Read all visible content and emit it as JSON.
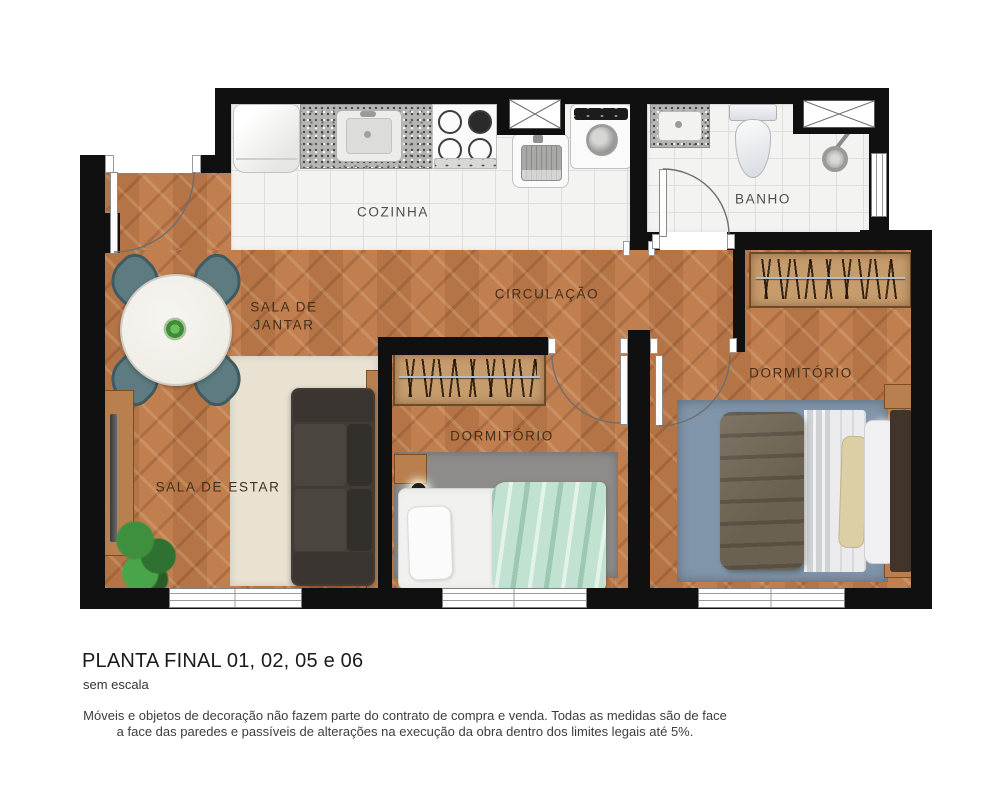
{
  "rooms": {
    "kitchen": "COZINHA",
    "bathroom": "BANHO",
    "dining": "SALA DE JANTAR",
    "living": "SALA DE ESTAR",
    "hallway": "CIRCULAÇÃO",
    "bedroom1": "DORMITÓRIO",
    "bedroom2": "DORMITÓRIO"
  },
  "title_block": {
    "title": "PLANTA FINAL 01, 02, 05 e 06",
    "scale_note": "sem escala",
    "disclaimer_line1": "Móveis e objetos de decoração não fazem parte do contrato de compra e venda. Todas as medidas são de face",
    "disclaimer_line2": "a face das paredes e passíveis de alterações na execução da obra dentro dos limites legais até 5%."
  },
  "colors": {
    "wall": "#101010",
    "wood": "#bb7a4c",
    "tile": "#f3f3f1",
    "grout": "#e0dfdd",
    "granite": "#b5b5b3",
    "rug_living": "#e9e1d1",
    "rug_gray": "#8d8c8a",
    "rug_blue": "#8094aa",
    "sofa": "#413c36",
    "chair": "#5d7b80",
    "table": "#f0ede7",
    "mint": "#c2e2d1",
    "wardrobe": "#c79c6d",
    "furniture_wood": "#b97f4e",
    "khaki": "#6b6150",
    "label_dark": "#41301d",
    "label_gray": "#4e4e4e"
  }
}
